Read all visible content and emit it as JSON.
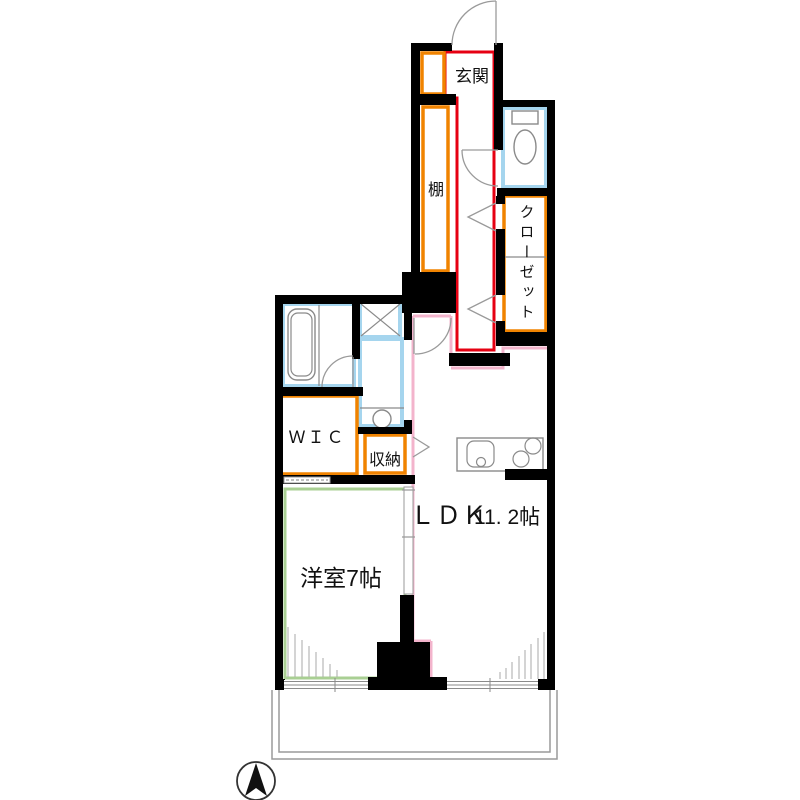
{
  "rooms": {
    "entrance": {
      "label": "玄関"
    },
    "shelf": {
      "label": "棚"
    },
    "closet": {
      "label": "クローゼット"
    },
    "wic": {
      "label": "ＷＩＣ"
    },
    "storage": {
      "label": "収納"
    },
    "ldk": {
      "label": "ＬＤＫ",
      "size": "11. 2帖"
    },
    "bedroom": {
      "label": "洋室7帖"
    }
  },
  "fixtures": [
    "toilet-icon",
    "bathtub-icon",
    "washbasin-icon",
    "washer-space-icon",
    "kitchen-sink-icon",
    "stove-icon",
    "north-arrow-icon"
  ],
  "colors": {
    "bg": "#ffffff",
    "wall": "#000000",
    "entrance_line": "#e60012",
    "storage_line": "#f08300",
    "water_line": "#a5d5ee",
    "ldk_line": "#f3b4cc",
    "bedroom_line": "#a9cf93",
    "fixture_line": "#8a8a8a",
    "door_line": "#9a9a9a",
    "balcony_line": "#9a9a9a",
    "text": "#111111"
  }
}
